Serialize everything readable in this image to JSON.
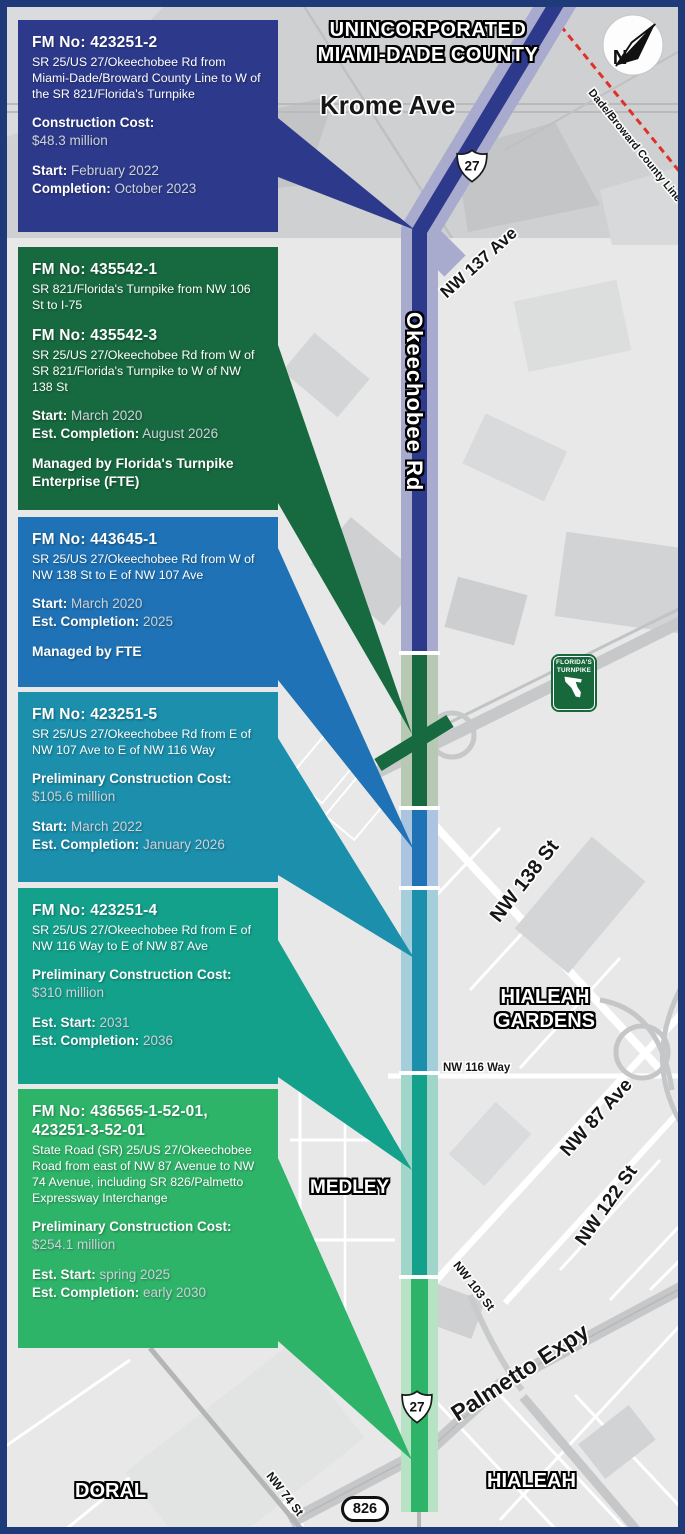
{
  "map": {
    "title_line1": "UNINCORPORATED",
    "title_line2": "MIAMI-DADE COUNTY",
    "labels": {
      "krome": "Krome Ave",
      "nw137": "NW 137 Ave",
      "okeechobee": "Okeechobee Rd",
      "county_line": "Dade/Broward County Line",
      "nw138": "NW 138 St",
      "hialeah_gardens_line1": "HIALEAH",
      "hialeah_gardens_line2": "GARDENS",
      "nw116": "NW 116 Way",
      "nw87": "NW 87 Ave",
      "nw122": "NW 122 St",
      "medley": "MEDLEY",
      "nw103": "NW 103 St",
      "palmetto": "Palmetto Expy",
      "hialeah": "HIALEAH",
      "doral": "DORAL",
      "nw74": "NW 74 St"
    },
    "shields": {
      "us27": "27",
      "sr826": "826"
    },
    "north_letter": "N",
    "turnpike_shield": {
      "line1": "FLORIDA'S",
      "line2": "TURNPIKE"
    },
    "road_band_colors": {
      "navy": "#a9abce",
      "green": "#b7c9b3",
      "blue": "#abc5e0",
      "teal": "#a5cedb",
      "tealgreen": "#a0d6ca",
      "brightgreen": "#b7e3c4"
    }
  },
  "projects": [
    {
      "color": "#2d3a8c",
      "fm": "FM No: 423251-2",
      "desc": "SR 25/US 27/Okeechobee Rd from Miami-Dade/Broward County Line to W of the SR 821/Florida's Turnpike",
      "cost_label": "Construction Cost:",
      "cost_value": "$48.3 million",
      "start_label": "Start:",
      "start_value": "February 2022",
      "end_label": "Completion:",
      "end_value": "October 2023"
    },
    {
      "color": "#17693f",
      "fm": "FM No: 435542-1",
      "desc": "SR 821/Florida's Turnpike from NW 106 St to I-75",
      "fm2": "FM No: 435542-3",
      "desc2": "SR 25/US 27/Okeechobee Rd from W of SR 821/Florida's Turnpike to W of NW 138 St",
      "start_label": "Start:",
      "start_value": "March 2020",
      "end_label": "Est. Completion:",
      "end_value": "August 2026",
      "managed": "Managed by Florida's Turnpike Enterprise (FTE)"
    },
    {
      "color": "#1e72b5",
      "fm": "FM No: 443645-1",
      "desc": "SR 25/US 27/Okeechobee Rd from W of NW 138 St to E of NW 107 Ave",
      "start_label": "Start:",
      "start_value": "March 2020",
      "end_label": "Est. Completion:",
      "end_value": "2025",
      "managed": "Managed by FTE"
    },
    {
      "color": "#1b8fac",
      "fm": "FM No: 423251-5",
      "desc": "SR 25/US 27/Okeechobee Rd from E of NW 107 Ave to E of NW 116 Way",
      "cost_label": "Preliminary Construction Cost:",
      "cost_value": "$105.6 million",
      "start_label": "Start:",
      "start_value": "March 2022",
      "end_label": "Est. Completion:",
      "end_value": "January 2026"
    },
    {
      "color": "#13a18c",
      "fm": "FM No: 423251-4",
      "desc": "SR 25/US 27/Okeechobee Rd from E of NW 116 Way to E of NW 87 Ave",
      "cost_label": "Preliminary Construction Cost:",
      "cost_value": "$310 million",
      "start_label": "Est. Start:",
      "start_value": "2031",
      "end_label": "Est. Completion:",
      "end_value": "2036"
    },
    {
      "color": "#2eb469",
      "fm": "FM No: 436565-1-52-01, 423251-3-52-01",
      "desc": "State Road (SR) 25/US 27/Okeechobee Road from east of NW 87 Avenue to NW 74 Avenue, including SR 826/Palmetto Expressway Interchange",
      "cost_label": "Preliminary Construction Cost:",
      "cost_value": "$254.1 million",
      "start_label": "Est. Start:",
      "start_value": "spring 2025",
      "end_label": "Est. Completion:",
      "end_value": "early 2030"
    }
  ]
}
